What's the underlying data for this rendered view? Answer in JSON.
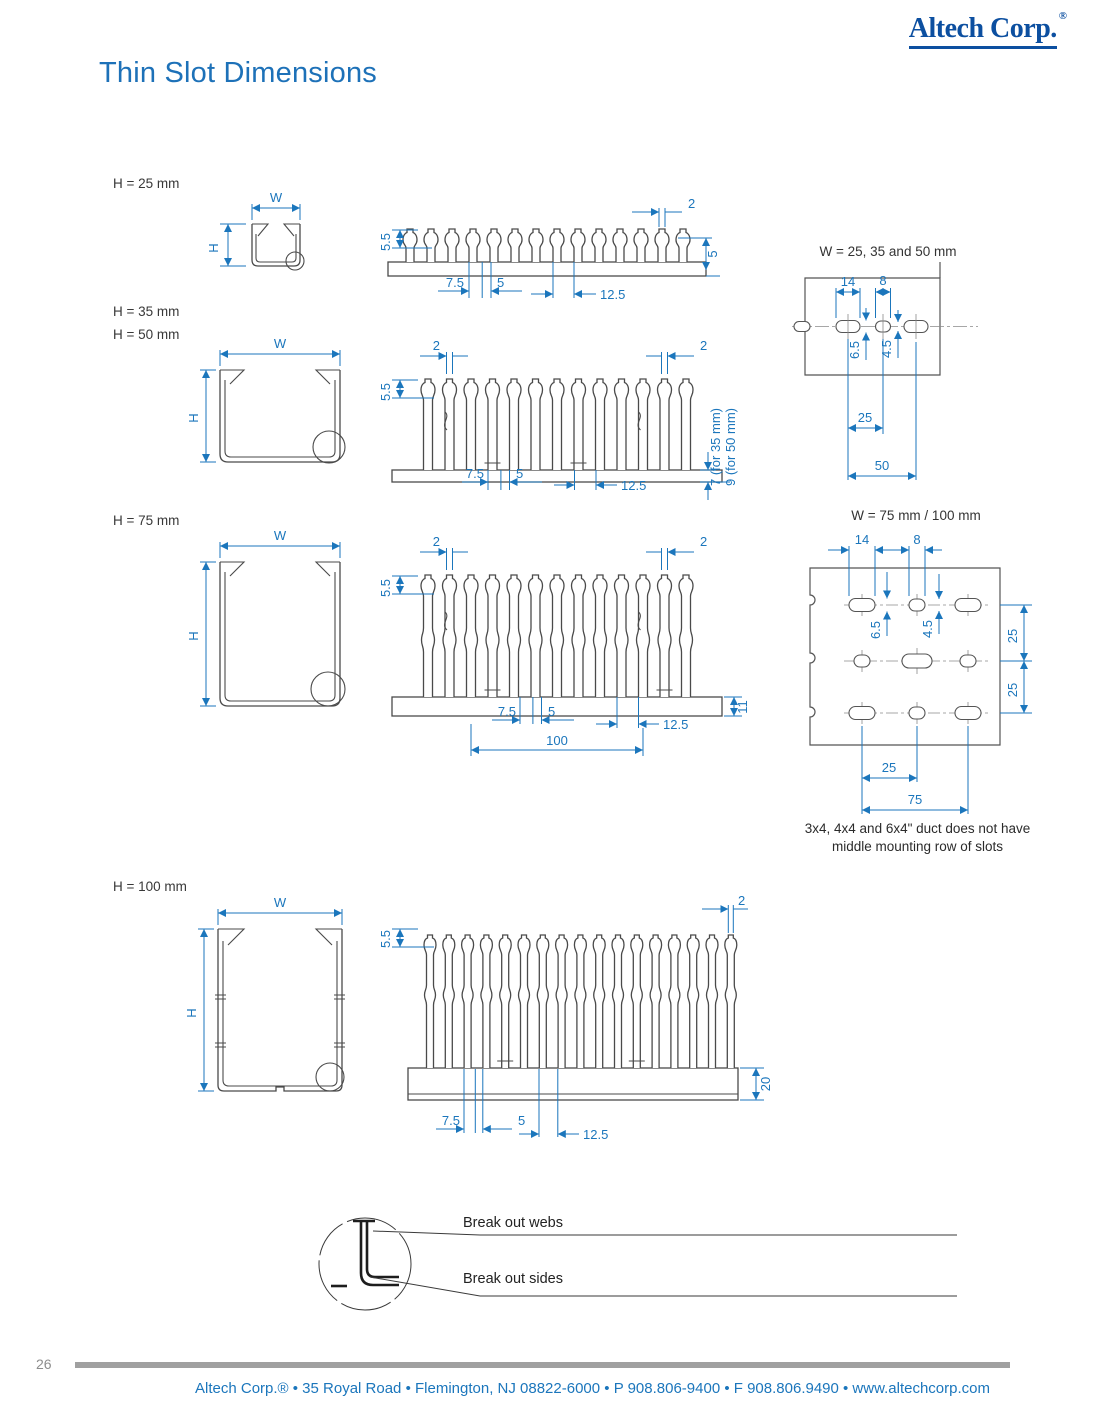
{
  "header": {
    "logo_text": "Altech Corp.",
    "logo_reg": "®",
    "page_title": "Thin Slot Dimensions"
  },
  "labels": {
    "w": "W",
    "h": "H"
  },
  "sections": {
    "h25": {
      "heading": "H = 25 mm",
      "dims": {
        "top_offset": "5.5",
        "tab_width": "2",
        "side_depth": "5",
        "pitch_half": "7.5",
        "slot_width": "5",
        "pitch": "12.5"
      }
    },
    "h35_50": {
      "heading_35": "H = 35 mm",
      "heading_50": "H = 50 mm",
      "dims": {
        "top_offset": "5.5",
        "tab_width_left": "2",
        "tab_width_right": "2",
        "pitch_half": "7.5",
        "slot_width": "5",
        "pitch": "12.5",
        "base_note_35": "7 (for 35 mm)",
        "base_note_50": "9 (for 50 mm)"
      }
    },
    "h75": {
      "heading": "H = 75 mm",
      "dims": {
        "top_offset": "5.5",
        "tab_width_left": "2",
        "tab_width_right": "2",
        "base_height": "11",
        "pitch_half": "7.5",
        "slot_width": "5",
        "pitch": "12.5",
        "overall_width": "100"
      }
    },
    "h100": {
      "heading": "H = 100 mm",
      "dims": {
        "top_offset": "5.5",
        "tab_width": "2",
        "base_height": "20",
        "pitch_half": "7.5",
        "slot_width": "5",
        "pitch": "12.5"
      }
    }
  },
  "mounting_small": {
    "title": "W = 25, 35 and 50 mm",
    "dims": {
      "slot_length": "14",
      "hole_length": "8",
      "slot_width": "6.5",
      "hole_width": "4.5",
      "spacing": "25",
      "overall": "50"
    }
  },
  "mounting_large": {
    "title": "W = 75 mm / 100 mm",
    "dims": {
      "slot_length": "14",
      "hole_length": "8",
      "slot_width": "6.5",
      "hole_width": "4.5",
      "row_spacing_top": "25",
      "row_spacing_bottom": "25",
      "col_spacing": "25",
      "col_overall": "75"
    },
    "note_line1": "3x4, 4x4 and 6x4\" duct does not have",
    "note_line2": "middle mounting row of slots"
  },
  "breakout": {
    "label_webs": "Break out webs",
    "label_sides": "Break out sides"
  },
  "footer": {
    "page_number": "26",
    "address": "Altech Corp.® • 35 Royal Road • Flemington, NJ 08822-6000 • P 908.806-9400 • F 908.806.9490 • www.altechcorp.com"
  },
  "colors": {
    "accent_blue": "#1b76bc",
    "logo_blue": "#0c4fa0",
    "line_dark": "#4a4a4a"
  }
}
